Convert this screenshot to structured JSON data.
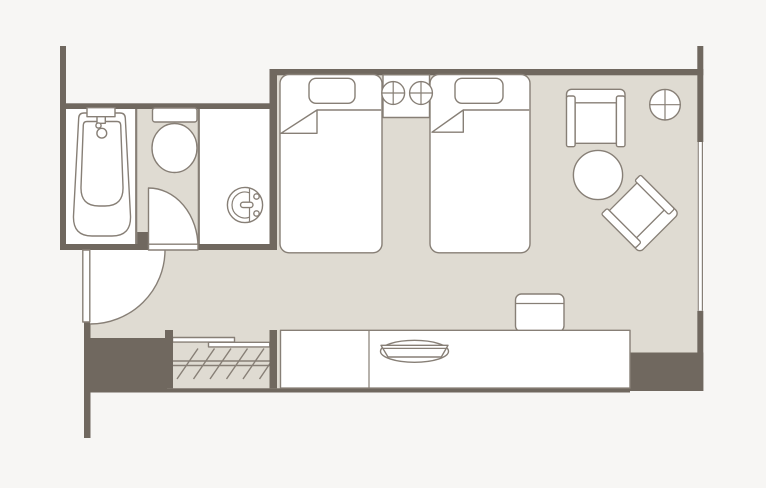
{
  "meta": {
    "type": "architectural-floor-plan",
    "subject": "hotel twin guest room",
    "visible_text": ""
  },
  "colors": {
    "background": "#f7f6f4",
    "floor": "#dfdbd2",
    "wall": "#70685f",
    "line": "#877f76",
    "furniture": "#ffffff"
  },
  "legend": {
    "rooms": [
      "bathtub-room",
      "toilet-room",
      "washbasin-room",
      "entrance-corridor",
      "main-bedroom"
    ],
    "fixtures": [
      "bathtub",
      "toilet",
      "washbasin",
      "entrance-door-swing",
      "toilet-room-door-swing",
      "closet-with-hangers",
      "twin-bed-left",
      "twin-bed-right",
      "nightstand",
      "bedside-lamp",
      "armchair",
      "lounge-chair-rotated",
      "round-table",
      "ceiling-light",
      "desk-counter",
      "desk-chair",
      "amenity-tray",
      "window"
    ]
  }
}
